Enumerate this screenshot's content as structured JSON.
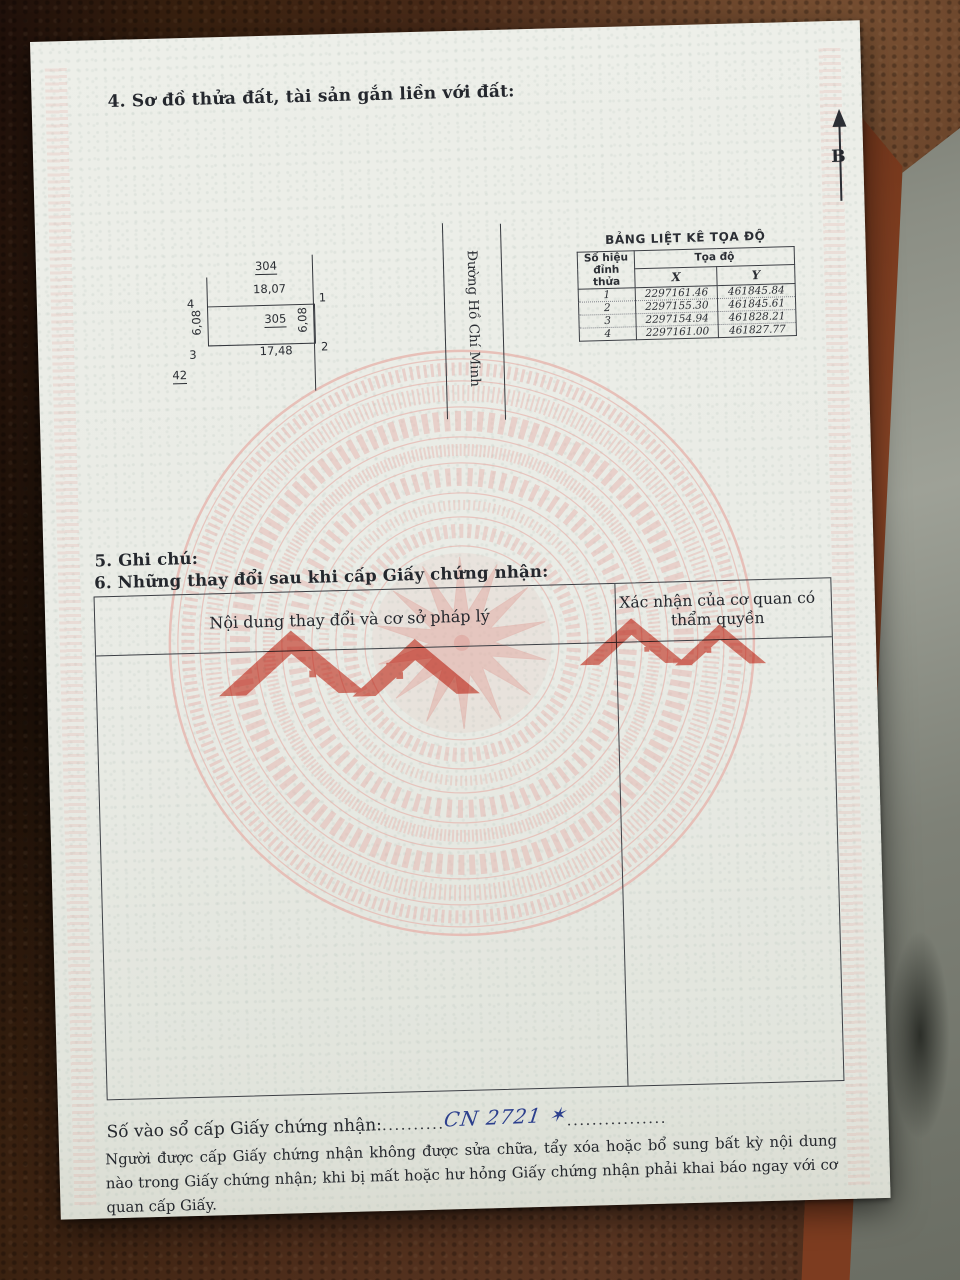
{
  "document": {
    "section4": {
      "title": "4. Sơ đồ thửa đất, tài sản gắn liền với đất:"
    },
    "compass": {
      "label": "B"
    },
    "diagram": {
      "adjacent_parcel_top": "304",
      "parcel_number": "305",
      "adjacent_parcel_bottom": "42",
      "edge_top": "18,07",
      "edge_bottom": "17,48",
      "edge_left": "6,08",
      "edge_right": "6,08",
      "vertex_1": "1",
      "vertex_2": "2",
      "vertex_3": "3",
      "vertex_4": "4",
      "road_name": "Đường Hồ Chí Minh"
    },
    "coordinate_table": {
      "title": "BẢNG LIỆT KÊ TỌA ĐỘ",
      "header_vertex": "Số hiệu đỉnh thửa",
      "header_coords": "Tọa độ",
      "header_x": "X",
      "header_y": "Y",
      "rows": [
        {
          "vertex": "1",
          "x": "2297161.46",
          "y": "461845.84"
        },
        {
          "vertex": "2",
          "x": "2297155.30",
          "y": "461845.61"
        },
        {
          "vertex": "3",
          "x": "2297154.94",
          "y": "461828.21"
        },
        {
          "vertex": "4",
          "x": "2297161.00",
          "y": "461827.77"
        }
      ]
    },
    "section5": {
      "title": "5. Ghi chú:"
    },
    "section6": {
      "title": "6. Những thay đổi sau khi cấp Giấy chứng nhận:"
    },
    "changes_table": {
      "header_content": "Nội dung thay đổi và cơ sở pháp lý",
      "header_confirmation": "Xác nhận của cơ quan có thẩm quyền"
    },
    "registry": {
      "label": "Số vào sổ cấp Giấy chứng nhận:",
      "dots_before": "..........",
      "number": "CN 2721 ✶",
      "dots_after": "................"
    },
    "footer": {
      "note": "Người được cấp Giấy chứng nhận không được sửa chữa, tẩy xóa hoặc bổ sung bất kỳ nội dung nào trong Giấy chứng nhận; khi bị mất hoặc hư hỏng Giấy chứng nhận phải khai báo ngay với cơ quan cấp Giấy."
    }
  },
  "colors": {
    "paper": "#e9ebe5",
    "ink": "#24272d",
    "drum_watermark": "#e6b4ad",
    "roof_watermark": "#dc5f51",
    "handwriting": "#2c3f8d",
    "leather": "#4b2c1b"
  }
}
